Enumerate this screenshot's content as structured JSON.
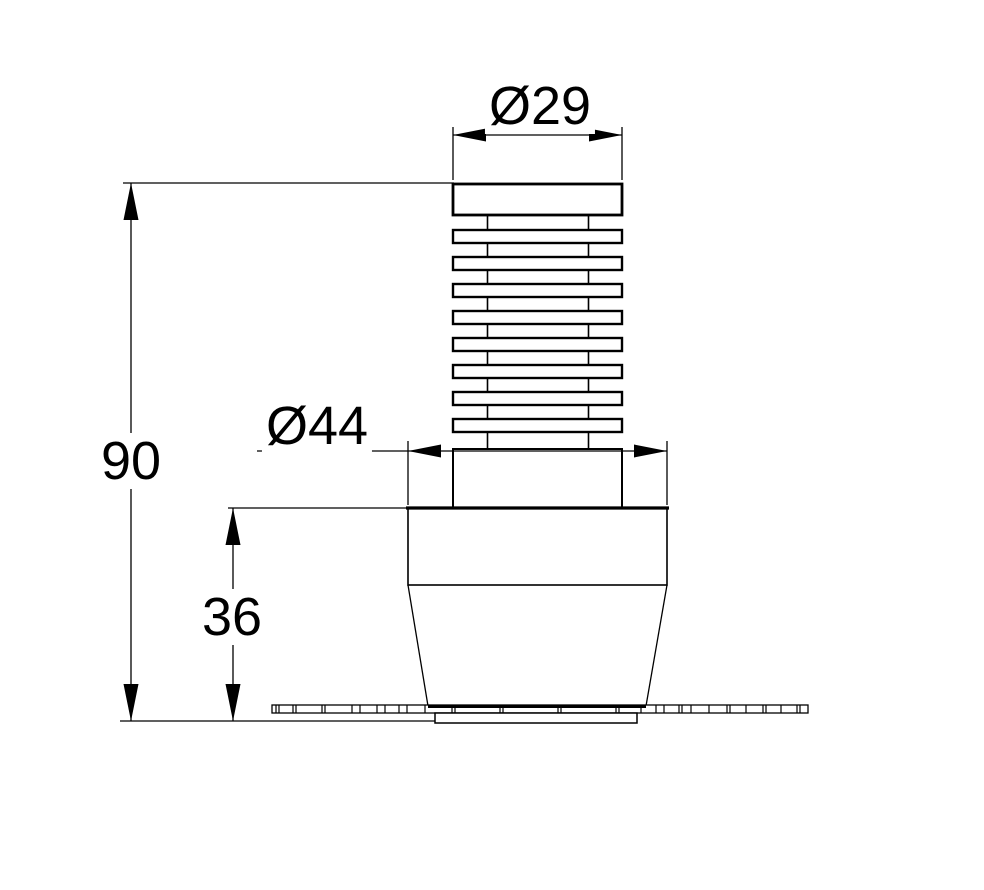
{
  "drawing": {
    "bg_color": "#ffffff",
    "line_color": "#000000",
    "labels": {
      "thread_diameter": "Ø29",
      "body_diameter": "Ø44",
      "overall_height": "90",
      "lower_body_height": "36"
    }
  }
}
